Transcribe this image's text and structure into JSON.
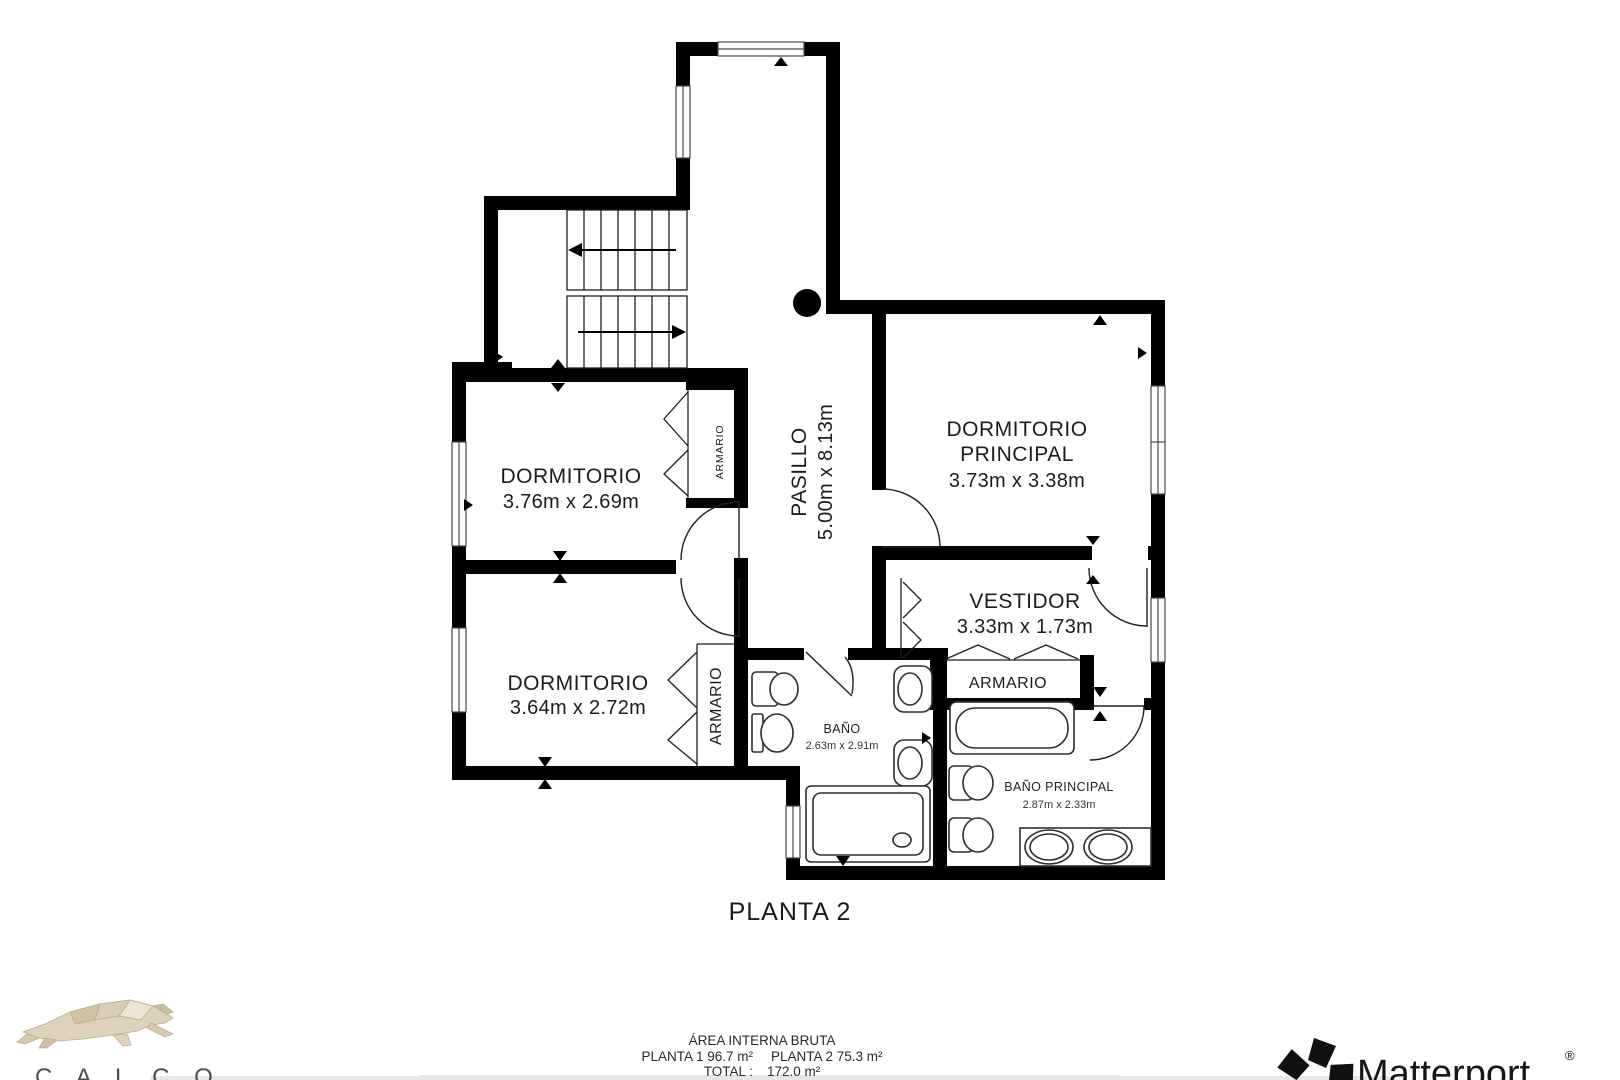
{
  "floor_plan": {
    "title": "PLANTA 2",
    "rooms": {
      "bedroom1": {
        "name": "DORMITORIO",
        "dims": "3.76m x 2.69m"
      },
      "bedroom2": {
        "name": "DORMITORIO",
        "dims": "3.64m x 2.72m"
      },
      "master_bedroom": {
        "name_line1": "DORMITORIO",
        "name_line2": "PRINCIPAL",
        "dims": "3.73m x 3.38m"
      },
      "hallway": {
        "name": "PASILLO",
        "dims": "5.00m x 8.13m"
      },
      "dressing_room": {
        "name": "VESTIDOR",
        "dims": "3.33m x 1.73m"
      },
      "bathroom": {
        "name": "BAÑO",
        "dims": "2.63m x 2.91m"
      },
      "master_bathroom": {
        "name": "BAÑO PRINCIPAL",
        "dims": "2.87m x 2.33m"
      },
      "closet_bedroom1": {
        "name": "ARMARIO"
      },
      "closet_bedroom2": {
        "name": "ARMARIO"
      },
      "closet_dressing": {
        "name": "ARMARIO"
      }
    }
  },
  "footer": {
    "area_title": "ÁREA INTERNA BRUTA",
    "planta1": "PLANTA 1 96.7 m²",
    "planta2": "PLANTA 2 75.3 m²",
    "total_label": "TOTAL :",
    "total_value": "172.0 m²"
  },
  "branding": {
    "calco_letters": "C A L C O",
    "matterport_name": "Matterport",
    "matterport_registered": "®"
  },
  "colors": {
    "wall": "#000000",
    "text": "#1c1c1c",
    "logo_tan": "#d8cdb5"
  }
}
